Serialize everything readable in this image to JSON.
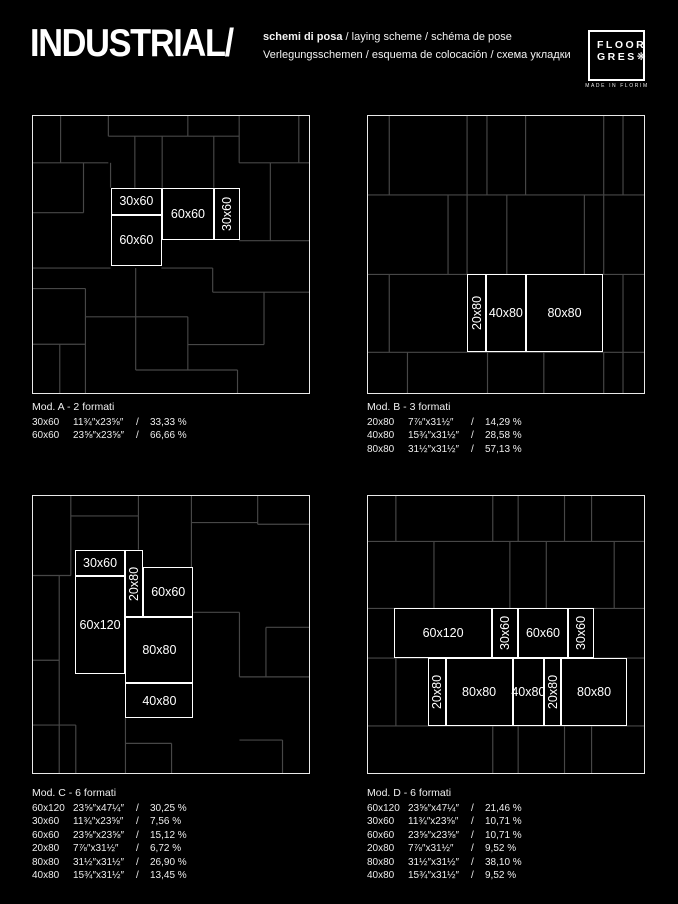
{
  "header": {
    "title": "INDUSTRIAL/",
    "subtitle_line1_bold": "schemi di posa",
    "subtitle_line1_rest": " / laying scheme / schéma de pose",
    "subtitle_line2": "Verlegungsschemen / esquema de colocación / схема укладки"
  },
  "logo": {
    "line1": "FLOOR",
    "line2": "GRES❋",
    "tagline": "MADE IN FLORIM"
  },
  "legend_separator": "/",
  "colors": {
    "background": "#000000",
    "faint_grid": "#474747",
    "panel_border": "#e9e9e9",
    "highlight": "#ffffff"
  },
  "panels": [
    {
      "id": "a",
      "title": "Mod. A - 2 formati",
      "pos": {
        "left": 32,
        "top": 115
      },
      "formats": [
        {
          "size": "30x60",
          "inches": "11¾″x23⅝″",
          "pct": "33,33 %"
        },
        {
          "size": "60x60",
          "inches": "23⅝″x23⅝″",
          "pct": "66,66 %"
        }
      ],
      "tiles": [
        {
          "x": 28.1,
          "y": 25.9,
          "w": 18.7,
          "h": 9.7,
          "label": "30x60",
          "vert": false
        },
        {
          "x": 28.1,
          "y": 35.6,
          "w": 18.7,
          "h": 18.4,
          "label": "60x60",
          "vert": false
        },
        {
          "x": 46.8,
          "y": 25.9,
          "w": 18.7,
          "h": 18.8,
          "label": "60x60",
          "vert": false
        },
        {
          "x": 65.5,
          "y": 25.9,
          "w": 9.6,
          "h": 18.8,
          "label": "30x60",
          "vert": true
        }
      ],
      "grid": [
        [
          10,
          0,
          10,
          16.9
        ],
        [
          27.3,
          0,
          27.3,
          7.3
        ],
        [
          56.1,
          0,
          56.1,
          7.3
        ],
        [
          74.7,
          0,
          74.7,
          16.9
        ],
        [
          96.3,
          0,
          96.3,
          16.9
        ],
        [
          27.3,
          7.3,
          74.7,
          7.3
        ],
        [
          36.9,
          7.3,
          36.9,
          25.9
        ],
        [
          46.8,
          7.3,
          46.8,
          25.9
        ],
        [
          65.5,
          7.3,
          65.5,
          25.9
        ],
        [
          0,
          16.9,
          27.3,
          16.9
        ],
        [
          74.7,
          16.9,
          100,
          16.9
        ],
        [
          18.3,
          16.9,
          18.3,
          34.9
        ],
        [
          28.1,
          16.9,
          28.1,
          25.9
        ],
        [
          0,
          34.9,
          18.3,
          34.9
        ],
        [
          86,
          16.9,
          86,
          45
        ],
        [
          74.7,
          45,
          100,
          45
        ],
        [
          46.5,
          54.9,
          65.1,
          54.9
        ],
        [
          65.1,
          54.9,
          65.1,
          63.6
        ],
        [
          65.1,
          63.6,
          100,
          63.6
        ],
        [
          83.7,
          63.6,
          83.7,
          82.5
        ],
        [
          56.1,
          82.5,
          83.7,
          82.5
        ],
        [
          0,
          54.9,
          28.1,
          54.9
        ],
        [
          0,
          62.3,
          19,
          62.3
        ],
        [
          19,
          62.3,
          19,
          100
        ],
        [
          37.2,
          54.9,
          37.2,
          91.7
        ],
        [
          19,
          72.5,
          56.1,
          72.5
        ],
        [
          56.1,
          72.5,
          56.1,
          91.7
        ],
        [
          0,
          82.4,
          19,
          82.4
        ],
        [
          9.7,
          82.4,
          9.7,
          100
        ],
        [
          37.2,
          91.7,
          74.1,
          91.7
        ],
        [
          74.1,
          91.7,
          74.1,
          100
        ]
      ]
    },
    {
      "id": "b",
      "title": "Mod. B - 3 formati",
      "pos": {
        "left": 367,
        "top": 115
      },
      "formats": [
        {
          "size": "20x80",
          "inches": "7⅞″x31½″",
          "pct": "14,29 %"
        },
        {
          "size": "40x80",
          "inches": "15¾″x31½″",
          "pct": "28,58 %"
        },
        {
          "size": "80x80",
          "inches": "31½″x31½″",
          "pct": "57,13 %"
        }
      ],
      "tiles": [
        {
          "x": 36.0,
          "y": 57.2,
          "w": 6.8,
          "h": 28.1,
          "label": "20x80",
          "vert": true
        },
        {
          "x": 42.8,
          "y": 57.2,
          "w": 14.3,
          "h": 28.1,
          "label": "40x80",
          "vert": false
        },
        {
          "x": 57.1,
          "y": 57.2,
          "w": 28.2,
          "h": 28.1,
          "label": "80x80",
          "vert": false
        }
      ],
      "grid": [
        [
          0,
          28.5,
          100,
          28.5
        ],
        [
          0,
          57.2,
          100,
          57.2
        ],
        [
          0,
          85.3,
          100,
          85.3
        ],
        [
          7.7,
          0,
          7.7,
          28.5
        ],
        [
          35.9,
          0,
          35.9,
          28.5
        ],
        [
          43.1,
          0,
          43.1,
          28.5
        ],
        [
          57.1,
          0,
          57.1,
          28.5
        ],
        [
          85.4,
          0,
          85.4,
          28.5
        ],
        [
          92.4,
          0,
          92.4,
          28.5
        ],
        [
          29,
          28.5,
          29,
          57.2
        ],
        [
          35.9,
          28.5,
          35.9,
          57.2
        ],
        [
          50.3,
          28.5,
          50.3,
          57.2
        ],
        [
          78.4,
          28.5,
          78.4,
          57.2
        ],
        [
          85.4,
          28.5,
          85.4,
          57.2
        ],
        [
          7.7,
          57.2,
          7.7,
          85.3
        ],
        [
          92.4,
          57.2,
          92.4,
          85.3
        ],
        [
          14.3,
          85.3,
          14.3,
          100
        ],
        [
          43.3,
          85.3,
          43.3,
          100
        ],
        [
          63.7,
          85.3,
          63.7,
          100
        ],
        [
          85.4,
          85.3,
          85.4,
          100
        ],
        [
          92.4,
          85.3,
          92.4,
          100
        ]
      ]
    },
    {
      "id": "c",
      "title": "Mod. C - 6 formati",
      "pos": {
        "left": 32,
        "top": 495
      },
      "formats": [
        {
          "size": "60x120",
          "inches": "23⅝″x47¼″",
          "pct": "30,25 %"
        },
        {
          "size": "30x60",
          "inches": "11¾″x23⅝″",
          "pct": "7,56 %"
        },
        {
          "size": "60x60",
          "inches": "23⅝″x23⅝″",
          "pct": "15,12 %"
        },
        {
          "size": "20x80",
          "inches": "7⅞″x31½″",
          "pct": "6,72 %"
        },
        {
          "size": "80x80",
          "inches": "31½″x31½″",
          "pct": "26,90 %"
        },
        {
          "size": "40x80",
          "inches": "15¾″x31½″",
          "pct": "13,45 %"
        }
      ],
      "tiles": [
        {
          "x": 15.1,
          "y": 19.4,
          "w": 18.4,
          "h": 9.6,
          "label": "30x60",
          "vert": false
        },
        {
          "x": 33.5,
          "y": 19.4,
          "w": 6.4,
          "h": 24.4,
          "label": "20x80",
          "vert": true
        },
        {
          "x": 39.9,
          "y": 25.5,
          "w": 18.2,
          "h": 18.2,
          "label": "60x60",
          "vert": false
        },
        {
          "x": 15.1,
          "y": 29.0,
          "w": 18.4,
          "h": 35.2,
          "label": "60x120",
          "vert": false
        },
        {
          "x": 33.5,
          "y": 43.7,
          "w": 24.6,
          "h": 23.9,
          "label": "80x80",
          "vert": false
        },
        {
          "x": 33.5,
          "y": 67.6,
          "w": 24.6,
          "h": 12.6,
          "label": "40x80",
          "vert": false
        }
      ],
      "grid": [
        [
          13.7,
          0,
          13.7,
          28.7
        ],
        [
          13.7,
          7.2,
          38.2,
          7.2
        ],
        [
          38.2,
          0,
          38.2,
          7.2
        ],
        [
          38.2,
          7.2,
          38.2,
          19.4
        ],
        [
          57.4,
          0,
          57.4,
          28.7
        ],
        [
          57.4,
          9.6,
          81.4,
          9.6
        ],
        [
          81.4,
          0,
          81.4,
          10.2
        ],
        [
          81.4,
          10.2,
          100,
          10.2
        ],
        [
          0,
          28.7,
          13.7,
          28.7
        ],
        [
          9.5,
          28.7,
          9.5,
          100
        ],
        [
          0,
          59.3,
          9.5,
          59.3
        ],
        [
          0,
          82.7,
          15.5,
          82.7
        ],
        [
          15.5,
          82.7,
          15.5,
          100
        ],
        [
          33.5,
          80.2,
          33.5,
          100
        ],
        [
          33.5,
          89.3,
          50.2,
          89.3
        ],
        [
          50.2,
          89.3,
          50.2,
          100
        ],
        [
          84.4,
          47.4,
          100,
          47.4
        ],
        [
          84.4,
          47.4,
          84.4,
          65.3
        ],
        [
          74.8,
          42,
          74.8,
          65.3
        ],
        [
          74.8,
          65.3,
          100,
          65.3
        ],
        [
          58.1,
          42,
          74.8,
          42
        ],
        [
          74.8,
          88.1,
          90.4,
          88.1
        ],
        [
          90.4,
          88.1,
          90.4,
          100
        ]
      ]
    },
    {
      "id": "d",
      "title": "Mod. D - 6 formati",
      "pos": {
        "left": 367,
        "top": 495
      },
      "formats": [
        {
          "size": "60x120",
          "inches": "23⅝″x47¼″",
          "pct": "21,46 %"
        },
        {
          "size": "30x60",
          "inches": "11¾″x23⅝″",
          "pct": "10,71 %"
        },
        {
          "size": "60x60",
          "inches": "23⅝″x23⅝″",
          "pct": "10,71 %"
        },
        {
          "size": "20x80",
          "inches": "7⅞″x31½″",
          "pct": "9,52 %"
        },
        {
          "size": "80x80",
          "inches": "31½″x31½″",
          "pct": "38,10 %"
        },
        {
          "size": "40x80",
          "inches": "15¾″x31½″",
          "pct": "9,52 %"
        }
      ],
      "tiles": [
        {
          "x": 9.5,
          "y": 40.6,
          "w": 35.4,
          "h": 17.9,
          "label": "60x120",
          "vert": false
        },
        {
          "x": 44.9,
          "y": 40.6,
          "w": 9.5,
          "h": 17.9,
          "label": "30x60",
          "vert": true
        },
        {
          "x": 54.4,
          "y": 40.6,
          "w": 18.0,
          "h": 17.9,
          "label": "60x60",
          "vert": false
        },
        {
          "x": 72.4,
          "y": 40.6,
          "w": 9.4,
          "h": 17.9,
          "label": "30x60",
          "vert": true
        },
        {
          "x": 21.8,
          "y": 58.5,
          "w": 6.3,
          "h": 24.5,
          "label": "20x80",
          "vert": true
        },
        {
          "x": 28.1,
          "y": 58.5,
          "w": 24.3,
          "h": 24.5,
          "label": "80x80",
          "vert": false
        },
        {
          "x": 52.4,
          "y": 58.5,
          "w": 11.4,
          "h": 24.5,
          "label": "40x80",
          "vert": false
        },
        {
          "x": 63.8,
          "y": 58.5,
          "w": 6.2,
          "h": 24.5,
          "label": "20x80",
          "vert": true
        },
        {
          "x": 70.0,
          "y": 58.5,
          "w": 23.8,
          "h": 24.5,
          "label": "80x80",
          "vert": false
        }
      ],
      "grid": [
        [
          0,
          16.4,
          100,
          16.4
        ],
        [
          0,
          40.6,
          100,
          40.6
        ],
        [
          0,
          58.5,
          100,
          58.5
        ],
        [
          0,
          83,
          100,
          83
        ],
        [
          10.1,
          0,
          10.1,
          16.4
        ],
        [
          45.2,
          0,
          45.2,
          16.4
        ],
        [
          54.4,
          0,
          54.4,
          16.4
        ],
        [
          71.2,
          0,
          71.2,
          16.4
        ],
        [
          81,
          0,
          81,
          16.4
        ],
        [
          23.9,
          16.4,
          23.9,
          40.6
        ],
        [
          51.4,
          16.4,
          51.4,
          40.6
        ],
        [
          64.6,
          16.4,
          64.6,
          40.6
        ],
        [
          89.2,
          16.4,
          89.2,
          40.6
        ],
        [
          10.1,
          58.5,
          10.1,
          83
        ],
        [
          45.2,
          83,
          45.2,
          100
        ],
        [
          54.4,
          83,
          54.4,
          100
        ],
        [
          71.2,
          83,
          71.2,
          100
        ],
        [
          81,
          83,
          81,
          100
        ]
      ]
    }
  ]
}
